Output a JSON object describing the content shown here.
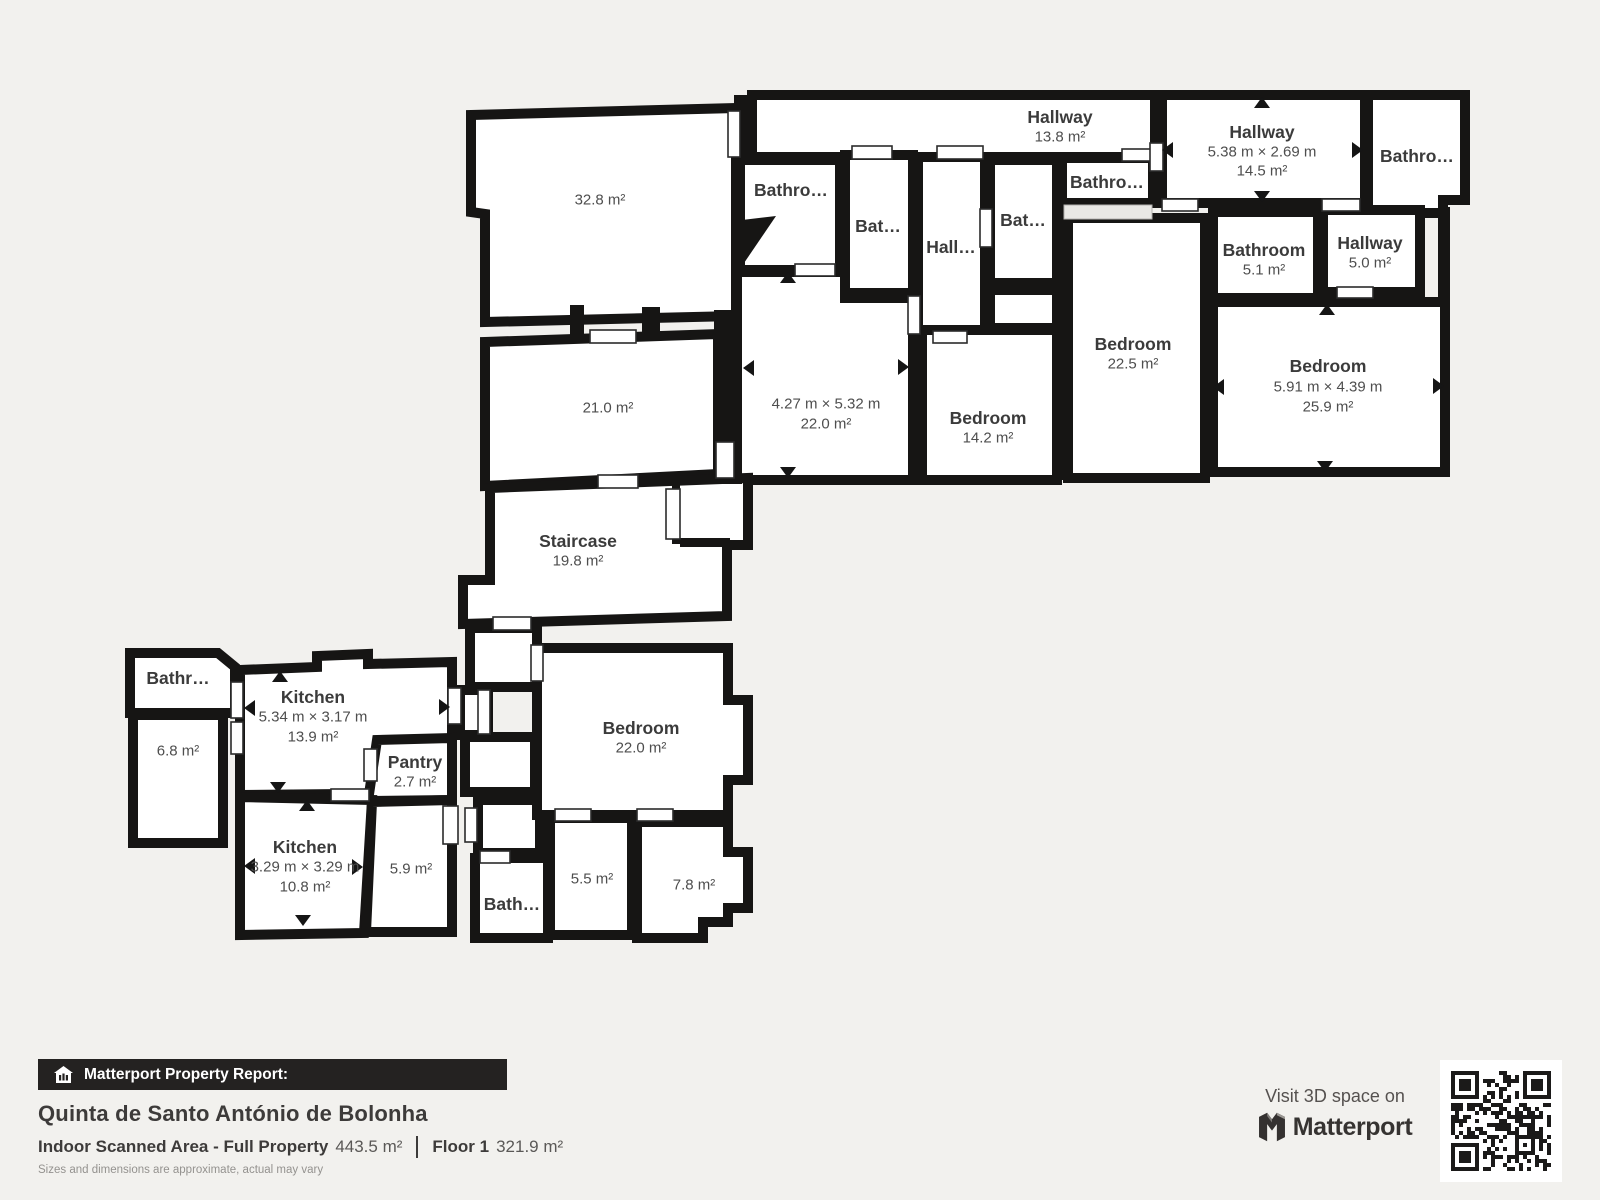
{
  "colors": {
    "background": "#f2f1ee",
    "wall": "#161514",
    "room_fill": "#ffffff",
    "label": "#3b3b3b",
    "value": "#4e4e4e",
    "footer_bar": "#242221"
  },
  "rooms": [
    {
      "name": "Hallway",
      "area": "13.8 m²"
    },
    {
      "name": "Hallway",
      "dims": "5.38 m × 2.69 m",
      "area": "14.5 m²"
    },
    {
      "name": "Bathro…"
    },
    {
      "area": "32.8 m²"
    },
    {
      "name": "Bathro…"
    },
    {
      "name": "Bat…"
    },
    {
      "name": "Hall…"
    },
    {
      "name": "Bat…"
    },
    {
      "name": "Bathro…"
    },
    {
      "name": "Bathroom",
      "area": "5.1 m²"
    },
    {
      "name": "Hallway",
      "area": "5.0 m²"
    },
    {
      "name": "Bedroom",
      "area": "22.5 m²"
    },
    {
      "name": "Bedroom",
      "dims": "5.91 m × 4.39 m",
      "area": "25.9 m²"
    },
    {
      "dims": "4.27 m × 5.32 m",
      "area": "22.0 m²"
    },
    {
      "name": "Bedroom",
      "area": "14.2 m²"
    },
    {
      "area": "21.0 m²"
    },
    {
      "name": "Staircase",
      "area": "19.8 m²"
    },
    {
      "name": "Bathr…"
    },
    {
      "area": "6.8 m²"
    },
    {
      "name": "Kitchen",
      "dims": "5.34 m × 3.17 m",
      "area": "13.9 m²"
    },
    {
      "name": "Pantry",
      "area": "2.7 m²"
    },
    {
      "name": "Kitchen",
      "dims": "3.29 m × 3.29 m",
      "area": "10.8 m²"
    },
    {
      "area": "5.9 m²"
    },
    {
      "name": "Bedroom",
      "area": "22.0 m²"
    },
    {
      "name": "Bath…"
    },
    {
      "area": "5.5 m²"
    },
    {
      "area": "7.8 m²"
    }
  ],
  "footer": {
    "badge_label": "Matterport Property Report:",
    "title": "Quinta de Santo António de Bolonha",
    "area_label": "Indoor Scanned Area - Full Property",
    "area_value": "443.5 m²",
    "floor_label": "Floor 1",
    "floor_value": "321.9 m²",
    "disclaimer": "Sizes and dimensions are approximate, actual may vary",
    "visit": "Visit 3D space on",
    "brand": "Matterport"
  }
}
